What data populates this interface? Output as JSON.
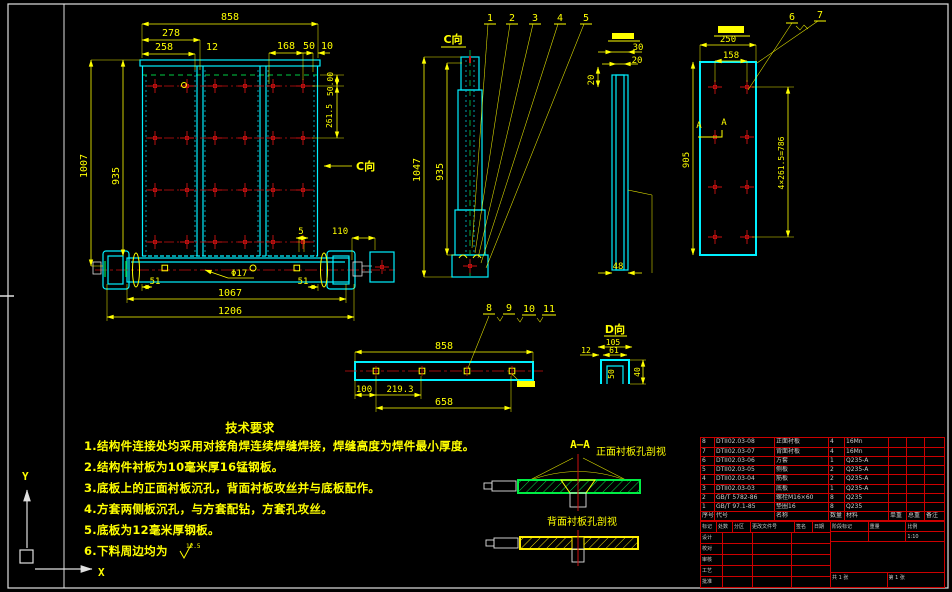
{
  "front_view": {
    "arrow_label": "C向",
    "dims": {
      "w858": "858",
      "w278": "278",
      "w258": "258",
      "t12": "12",
      "w168": "168",
      "w50": "50",
      "w10": "10",
      "h1007": "1007",
      "h935": "935",
      "off50": "50.00",
      "sp261": "261.5",
      "e51l": "51",
      "w1067": "1067",
      "e51r": "51",
      "w1206": "1206",
      "hole": "Φ17",
      "g5": "5",
      "g110": "110"
    }
  },
  "c_view": {
    "title": "C向",
    "dims": {
      "h1047": "1047",
      "h935": "935"
    },
    "balloons": [
      "1",
      "2",
      "3",
      "4",
      "5"
    ]
  },
  "side_view": {
    "dims": {
      "t30": "30",
      "t20": "20",
      "l20": "20",
      "b48": "48"
    }
  },
  "back_view": {
    "dims": {
      "w250": "250",
      "w158": "158",
      "h905": "905",
      "rows": "4×261.5=786"
    },
    "section_mark_a": "A",
    "section_mark_b": "A",
    "balloons": [
      "6",
      "7"
    ]
  },
  "d_bar": {
    "dims": {
      "w858": "858",
      "w658": "658",
      "o100": "100",
      "p219": "219.3"
    },
    "balloons": [
      "8",
      "9",
      "10",
      "11"
    ]
  },
  "d_channel": {
    "title": "D向",
    "dims": {
      "w105": "105",
      "w61": "61",
      "t12": "12",
      "h50": "50",
      "h40": "40"
    }
  },
  "tech_requirements": {
    "title": "技术要求",
    "items": [
      "1.结构件连接处均采用对接角焊连续焊缝焊接，焊缝高度为焊件最小厚度。",
      "2.结构件衬板为10毫米厚16锰钢板。",
      "3.底板上的正面衬板沉孔，背面衬板攻丝并与底板配作。",
      "4.方套两侧板沉孔，与方套配钻，方套孔攻丝。",
      "5.底板为12毫米厚钢板。",
      "6.下料周边均为"
    ],
    "roughness": "12.5"
  },
  "section_detail": {
    "label": "A—A",
    "front_label": "正面衬板孔剖视",
    "back_label": "背面衬板孔剖视"
  },
  "axes": {
    "x": "X",
    "y": "Y"
  },
  "bom": {
    "header": [
      "序号",
      "代号",
      "名称",
      "数量",
      "材料",
      "单重",
      "总重",
      "备注"
    ],
    "rows": [
      [
        "8",
        "DTII02.03-08",
        "正面衬板",
        "4",
        "16Mn",
        "",
        "",
        ""
      ],
      [
        "7",
        "DTII02.03-07",
        "背面衬板",
        "4",
        "16Mn",
        "",
        "",
        ""
      ],
      [
        "6",
        "DTII02.03-06",
        "方套",
        "1",
        "Q235-A",
        "",
        "",
        ""
      ],
      [
        "5",
        "DTII02.03-05",
        "侧板",
        "2",
        "Q235-A",
        "",
        "",
        ""
      ],
      [
        "4",
        "DTII02.03-04",
        "筋板",
        "2",
        "Q235-A",
        "",
        "",
        ""
      ],
      [
        "3",
        "DTII02.03-03",
        "底板",
        "1",
        "Q235-A",
        "",
        "",
        ""
      ],
      [
        "2",
        "GB/T 5782-86",
        "螺栓M16×60",
        "8",
        "Q235",
        "",
        "",
        ""
      ],
      [
        "1",
        "GB/T 97.1-85",
        "垫圈16",
        "8",
        "Q235",
        "",
        "",
        ""
      ]
    ]
  },
  "title_block": {
    "row1": [
      "标记",
      "处数",
      "分区",
      "更改文件号",
      "签名",
      "日期"
    ],
    "left_rows": [
      "设计",
      "校对",
      "审核",
      "工艺",
      "批准"
    ],
    "right": {
      "stage_label": "阶段标记",
      "weight_label": "重量",
      "scale_label": "比例",
      "scale": "1:10",
      "sheets": "共 1 张",
      "sheet_no": "第 1 张"
    }
  },
  "colors": {
    "line_cyan": "#00f0ff",
    "dim_yellow": "#ffff00",
    "center_red": "#cc1111",
    "hidden_green": "#00cc44",
    "frame_white": "#e0e0e0",
    "table_red": "#cc0000"
  }
}
